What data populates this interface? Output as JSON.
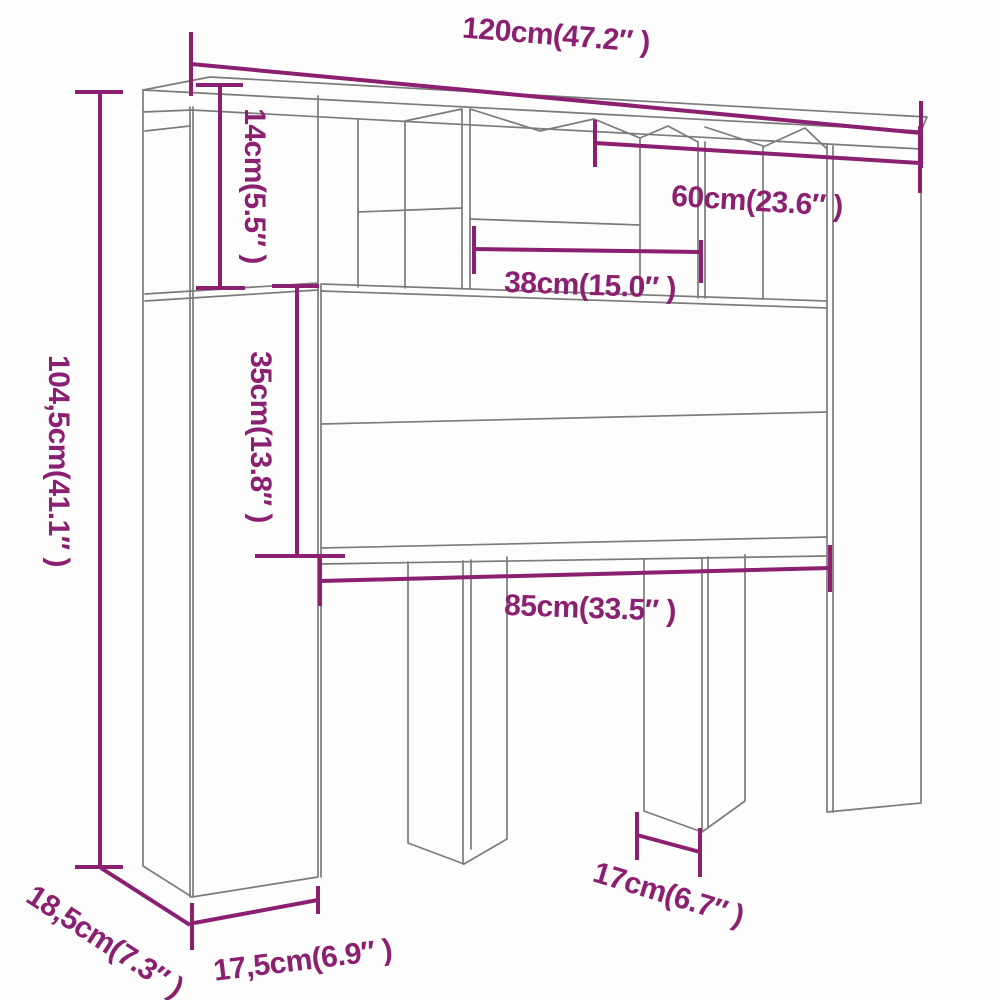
{
  "diagram": {
    "title": "headboard-cabinet-dimension-diagram",
    "colors": {
      "dimension_annotation": "#8b2070",
      "furniture_outline": "#7b7b7b",
      "background": "#ffffff"
    },
    "dimensions": {
      "total_width": "120cm(47.2″ )",
      "top_shelf_height": "14cm(5.5″ )",
      "inner_width_right": "60cm(23.6″ )",
      "inner_width_middle": "38cm(15.0″ )",
      "total_height": "104,5cm(41.1″ )",
      "panel_height": "35cm(13.8″ )",
      "opening_width": "85cm(33.5″ )",
      "leg_width": "17cm(6.7″ )",
      "depth": "18,5cm(7.3″ )",
      "side_column_width": "17,5cm(6.9″ )"
    }
  }
}
